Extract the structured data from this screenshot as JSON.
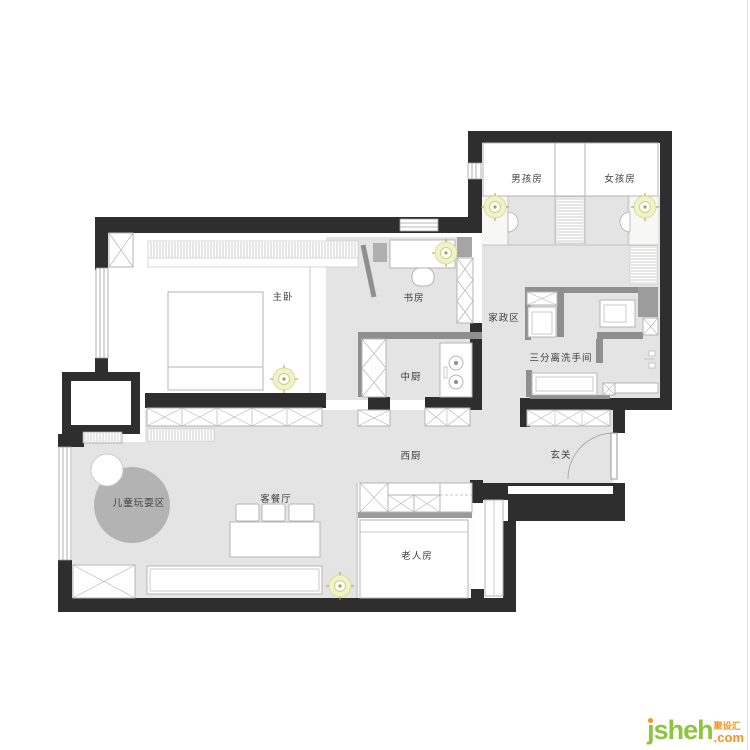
{
  "labels": {
    "master": "主卧",
    "study": "书房",
    "chinese_kitchen": "中厨",
    "west_kitchen": "西厨",
    "entry": "玄关",
    "housekeeping": "家政区",
    "bathroom": "三分离洗手间",
    "boys_room": "男孩房",
    "girls_room": "女孩房",
    "play_area": "儿童玩耍区",
    "living_dining": "客餐厅",
    "elderly_room": "老人房"
  },
  "watermark": {
    "brand": "jsheh",
    "cn": "聚设汇",
    "com": ".com",
    "brand_color": "#8cc63e",
    "accent_color": "#f7941e"
  },
  "colors": {
    "wall": "#2e2e2e",
    "partition": "#8f8f8f",
    "floor": "#e4e4e5",
    "furniture_stroke": "#b5b5b5",
    "label_text": "#3f3f3f",
    "light_halo": "#eef3c9",
    "light_ring": "#c8d27e",
    "play_rug": "#b3b3b3"
  }
}
